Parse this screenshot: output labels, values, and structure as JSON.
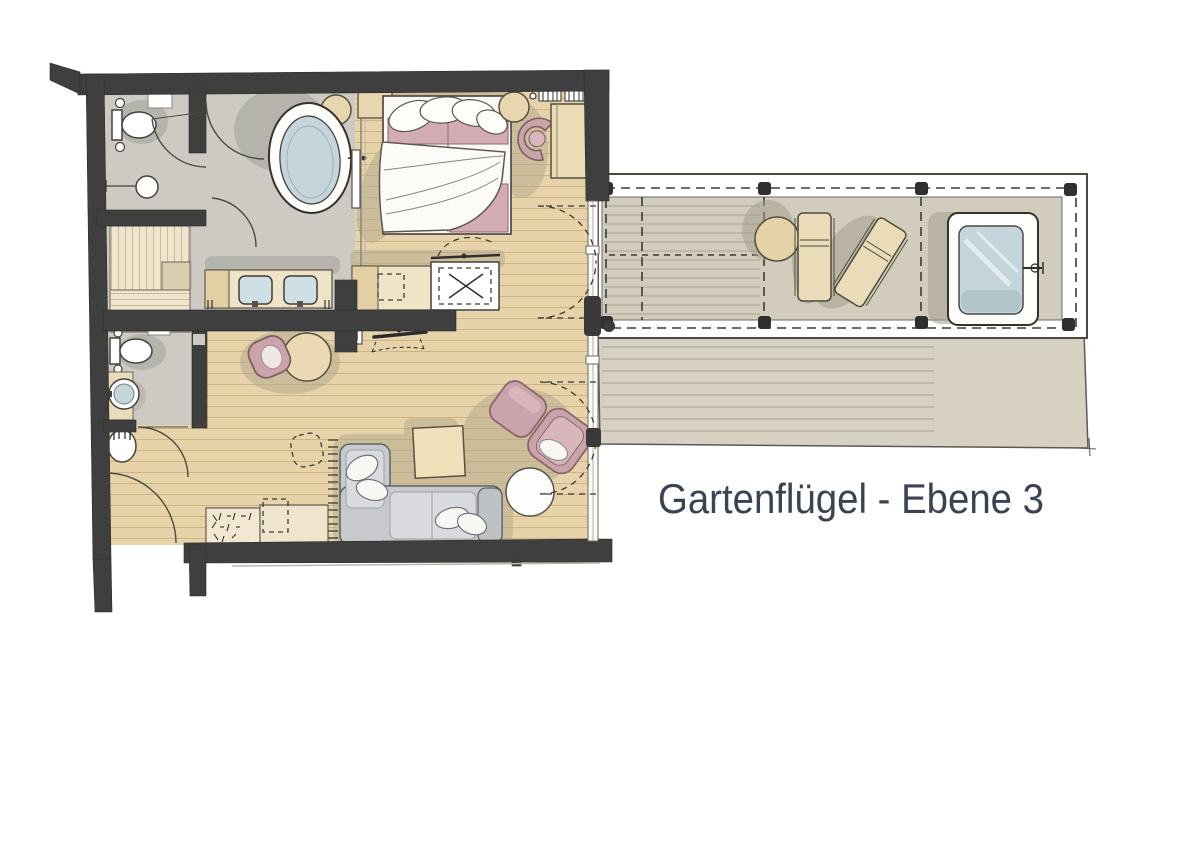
{
  "title": {
    "text": "Gartenflügel - Ebene 3",
    "color": "#3b4352"
  },
  "palette": {
    "background": "#ffffff",
    "wall": "#3f3f3f",
    "wood_floor": "#e6d3aa",
    "wood_floor_line": "#d0b483",
    "tile_floor": "#cccac2",
    "deck": "#d6d1c2",
    "deck_line": "#b2ac9b",
    "pergola_deck": "#d2ccbc",
    "accent_pink": "#cba3ab",
    "bed_pink": "#d3abb2",
    "water_blue": "#c4d6db",
    "sofa_gray": "#c7c9cc",
    "furniture_tan": "#e8d6ae",
    "shadow": "#b3a98c",
    "outline": "#55503f",
    "title_color": "#3b4352"
  },
  "rooms": [
    "bathroom",
    "wc",
    "sauna",
    "bedroom",
    "living-room",
    "entrance-hall",
    "second-wc",
    "terrace",
    "pergola"
  ],
  "furniture": [
    "bathtub",
    "double-vanity",
    "toilet",
    "washbasin",
    "sauna-bench",
    "double-bed",
    "nightstand",
    "pouf",
    "desk",
    "desk-chair",
    "radiator",
    "wardrobe-counter",
    "tv",
    "dining-table",
    "dining-chair",
    "sofa",
    "coffee-table",
    "side-table",
    "armchair",
    "ottoman",
    "sideboard",
    "outdoor-table",
    "sun-lounger",
    "hot-tub"
  ]
}
